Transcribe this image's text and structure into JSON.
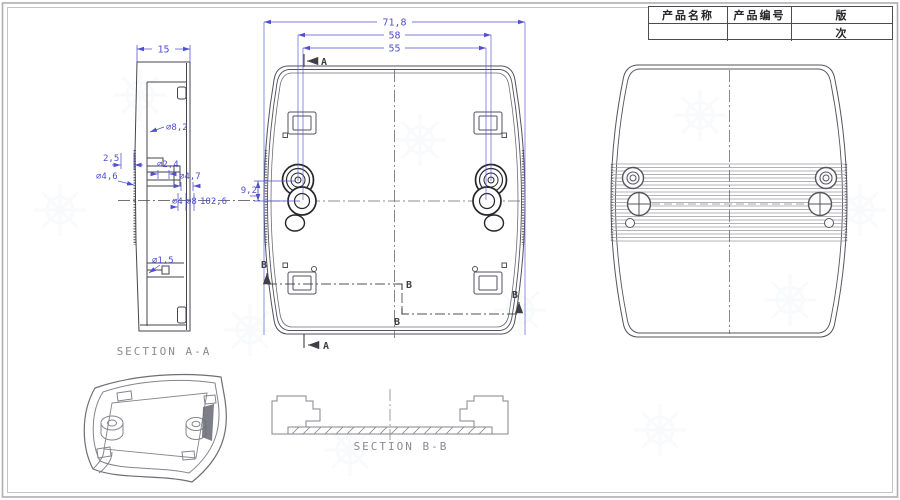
{
  "title_block": {
    "product_name_label": "产品名称",
    "product_code_label": "产品编号",
    "revision_label_top": "版",
    "revision_label_bottom": "次",
    "product_name_value": "",
    "product_code_value": "",
    "revision_value": ""
  },
  "labels": {
    "section_aa": "SECTION A-A",
    "section_bb": "SECTION B-B",
    "marker_a": "A",
    "marker_b": "B"
  },
  "dimensions": {
    "overall_width": "71,8",
    "boss_outer_span": "58",
    "boss_inner_span": "55",
    "side_thickness": "15",
    "hole_8_2": "⌀8,2",
    "offset_2_5": "2,5",
    "dia_4_6": "⌀4,6",
    "dia_2_4": "⌀2,4",
    "dia_4_7": "⌀4,7",
    "dia_4": "⌀4",
    "dia_8": "⌀8",
    "arc_102_6": "102,6",
    "dia_1_5": "⌀1,5",
    "boss_spacing": "9,2"
  },
  "colors": {
    "dimension_blue": "#4f4fd0",
    "line_dark": "#45454d",
    "line_light": "#84848c"
  }
}
